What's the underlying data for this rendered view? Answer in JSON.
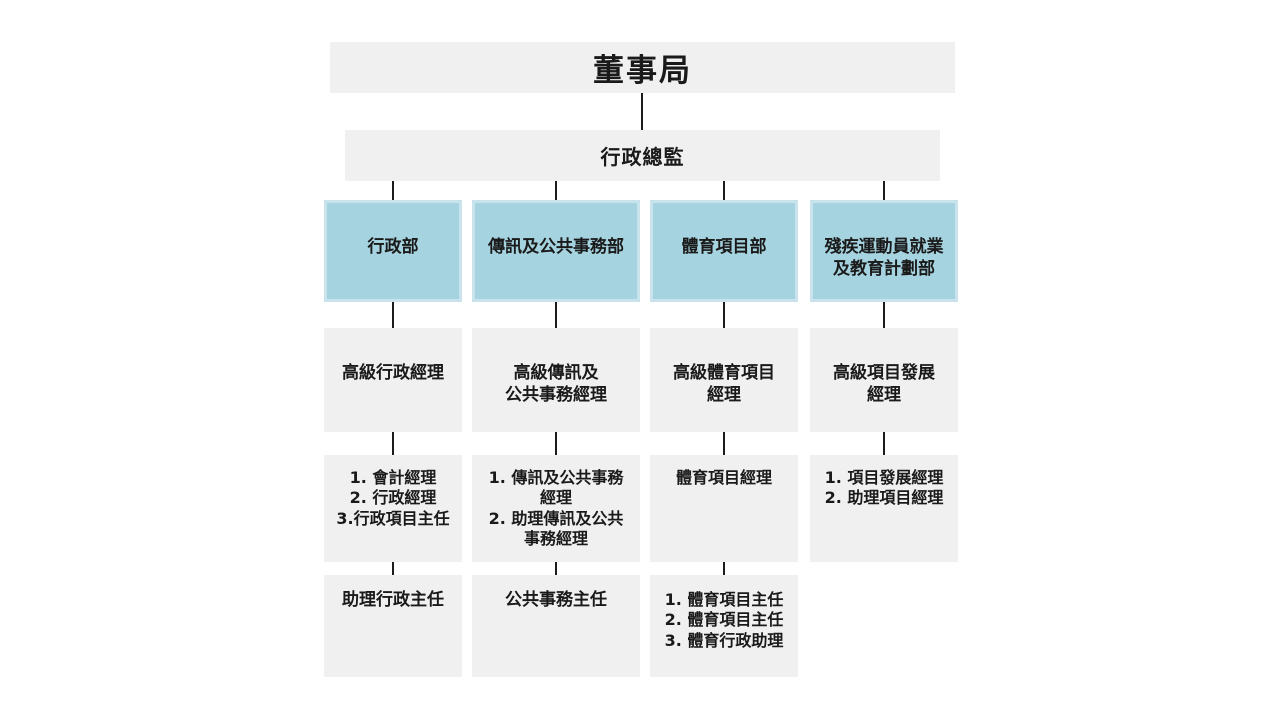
{
  "palette": {
    "background": "#ffffff",
    "box_gray": "#f1f0f0",
    "box_blue_fill": "#a6d3e0",
    "box_blue_border": "#c8e3eb",
    "connector_line": "#1c1c1c",
    "text": "#1a1a1a"
  },
  "chart": {
    "board": {
      "label": "董事局"
    },
    "ceo": {
      "label": "行政總監"
    },
    "columns": [
      {
        "dept": "行政部",
        "senior": "高級行政經理",
        "managers": {
          "items": [
            "1. 會計經理",
            "2. 行政經理",
            "3.行政項目主任"
          ]
        },
        "officers": {
          "items": [
            "助理行政主任"
          ]
        }
      },
      {
        "dept": "傳訊及公共事務部",
        "senior": "高級傳訊及\n公共事務經理",
        "managers": {
          "items": [
            "1. 傳訊及公共事務\n經理",
            "2. 助理傳訊及公共\n事務經理"
          ]
        },
        "officers": {
          "items": [
            "公共事務主任"
          ]
        }
      },
      {
        "dept": "體育項目部",
        "senior": "高級體育項目\n經理",
        "managers": {
          "items": [
            "體育項目經理"
          ]
        },
        "officers": {
          "items": [
            "1. 體育項目主任",
            "2. 體育項目主任",
            "3. 體育行政助理"
          ]
        }
      },
      {
        "dept": "殘疾運動員就業\n及教育計劃部",
        "senior": "高級項目發展\n經理",
        "managers": {
          "items": [
            "1. 項目發展經理",
            "2. 助理項目經理"
          ]
        },
        "officers": {
          "items": []
        }
      }
    ]
  }
}
